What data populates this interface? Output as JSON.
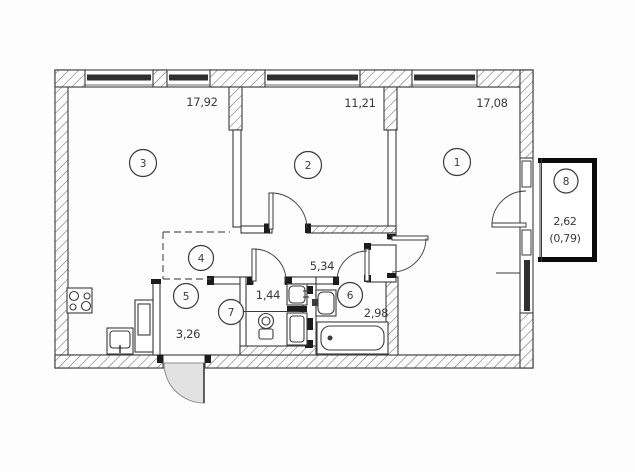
{
  "document": {
    "type": "apartment-floor-plan"
  },
  "colors": {
    "background": "#fdfdfd",
    "line": "#3b3b3b",
    "hatch": "#6e6e6e",
    "window_band": "#2f2f2f",
    "balcony_border": "#0b0b0b",
    "door_leaf_fill": "#e2e2e2",
    "text": "#3a3a3a"
  },
  "rooms": {
    "room1": {
      "number": "1",
      "area": "17,08"
    },
    "room2": {
      "number": "2",
      "area": "11,21"
    },
    "room3": {
      "number": "3",
      "area": "17,92"
    },
    "room4": {
      "number": "4"
    },
    "room5": {
      "number": "5",
      "area": "3,26"
    },
    "room6": {
      "number": "6",
      "area": "2,98"
    },
    "room7": {
      "number": "7",
      "area": "1,44"
    },
    "room8": {
      "number": "8",
      "area": "2,62",
      "area_secondary": "(0,79)"
    },
    "corridor": {
      "area": "5,34"
    }
  },
  "symbols": [
    "stove-symbol",
    "kitchen-sink-symbol",
    "refrigerator-symbol",
    "toilet-symbol",
    "wc-washbasin-symbol",
    "washing-machine-symbol",
    "bath-washbasin-symbol",
    "bathtub-symbol",
    "entrance-door-symbol",
    "window-symbol",
    "balcony"
  ]
}
